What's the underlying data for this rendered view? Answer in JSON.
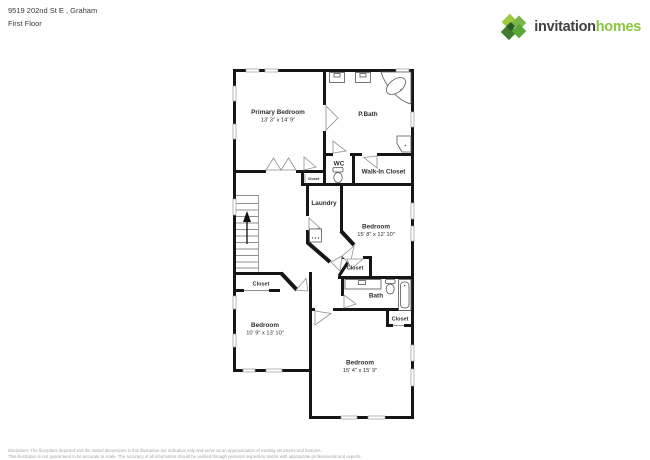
{
  "header": {
    "address": "9519 202nd St E , Graham",
    "floor": "First Floor"
  },
  "logo": {
    "icon": "invitation-homes-diamond-mark",
    "brand_dark": "invitation",
    "brand_green": "homes",
    "color_green": "#8cc63e",
    "color_dark": "#414042"
  },
  "rooms": [
    {
      "name": "Primary Bedroom",
      "dims": "13' 3\" x 14' 9\""
    },
    {
      "name": "P.Bath"
    },
    {
      "name": "WC"
    },
    {
      "name": "Walk-In Closet"
    },
    {
      "name": "Closet"
    },
    {
      "name": "Laundry"
    },
    {
      "name": "Bedroom",
      "dims": "15' 8\" x 12' 10\""
    },
    {
      "name": "Closet"
    },
    {
      "name": "Bath"
    },
    {
      "name": "Closet"
    },
    {
      "name": "Closet"
    },
    {
      "name": "Bedroom",
      "dims": "10' 9\" x 13' 10\""
    },
    {
      "name": "Bedroom",
      "dims": "15' 4\" x 15' 9\""
    }
  ],
  "disclaimer": {
    "line1": "Disclaimer: The floorplans depicted and the stated dimensions in this illustration are indicative only and serve as an approximation of existing structures and features.",
    "line2": "This illustration is not guaranteed to be accurate to scale. The accuracy of all information should be verified through personal inspection and/or with appropriate professionals and experts."
  },
  "plan": {
    "wall_color": "#161616",
    "door_color": "#8f8f8f",
    "label_color": "#2e2e2e"
  }
}
